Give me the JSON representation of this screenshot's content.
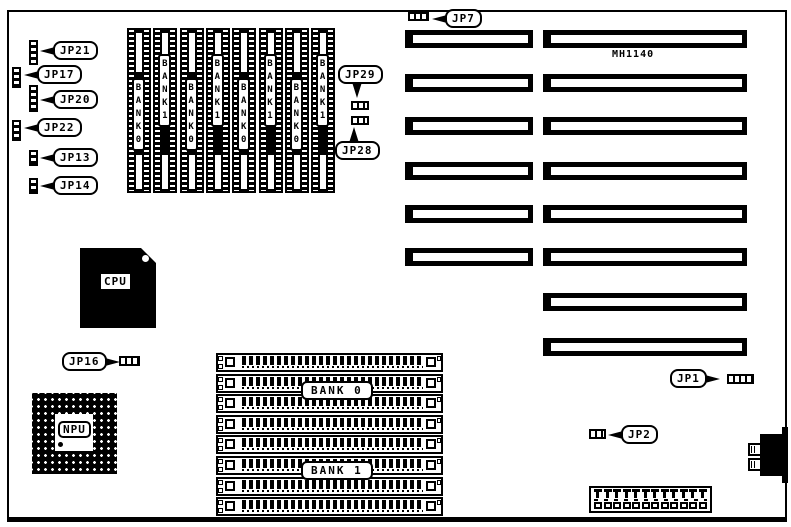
{
  "colors": {
    "ink": "#000000",
    "paper": "#ffffff"
  },
  "board": {
    "chip_label": "MH1140",
    "cpu_label": "CPU",
    "npu_label": "NPU"
  },
  "jumpers": {
    "jp21": {
      "label": "JP21"
    },
    "jp17": {
      "label": "JP17"
    },
    "jp20": {
      "label": "JP20"
    },
    "jp22": {
      "label": "JP22"
    },
    "jp13": {
      "label": "JP13"
    },
    "jp14": {
      "label": "JP14"
    },
    "jp16": {
      "label": "JP16"
    },
    "jp29": {
      "label": "JP29"
    },
    "jp28": {
      "label": "JP28"
    },
    "jp7": {
      "label": "JP7"
    },
    "jp1": {
      "label": "JP1"
    },
    "jp2": {
      "label": "JP2"
    }
  },
  "memory": {
    "dip_sockets": [
      "BANK 0",
      "BANK 1",
      "BANK 0",
      "BANK 1",
      "BANK 0",
      "BANK 1",
      "BANK 0",
      "BANK 1"
    ],
    "simm": {
      "rows": 8,
      "bank_labels": [
        "BANK 0",
        "BANK 1"
      ]
    }
  },
  "expansion_slots": {
    "left_column": 6,
    "right_column": 8
  },
  "power_connector": {
    "pins": 12
  }
}
